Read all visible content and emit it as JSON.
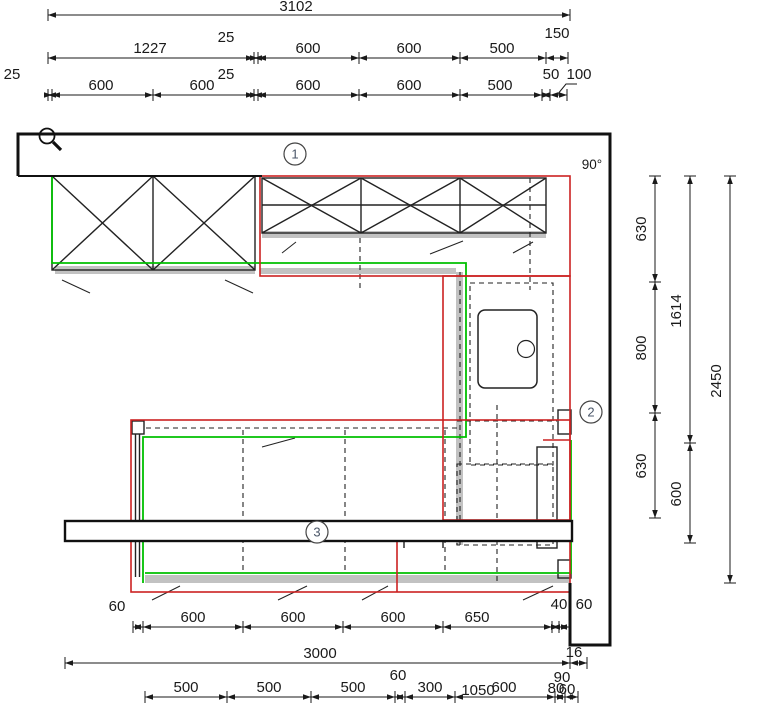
{
  "drawing": {
    "title": "kitchen-floor-plan",
    "angle_annotation": {
      "text": "90°",
      "x": 592,
      "y": 169
    },
    "callouts": [
      {
        "label": "1",
        "x": 295,
        "y": 154
      },
      {
        "label": "2",
        "x": 591,
        "y": 412
      },
      {
        "label": "3",
        "x": 317,
        "y": 532
      }
    ],
    "colors": {
      "dimension": "#1a1a1a",
      "wall": "#111111",
      "cabinet_outline_red": "#cc2222",
      "counter_outline_green": "#00c000",
      "shadow_gray": "#c2c2c2"
    },
    "dimension_chains": [
      {
        "id": "top-overall",
        "orientation": "h",
        "line": 15,
        "ticks": [
          48,
          570
        ],
        "labels": [
          {
            "text": "3102",
            "x": 296,
            "y": 11
          }
        ]
      },
      {
        "id": "top-row2",
        "orientation": "h",
        "line": 58,
        "ticks": [
          48,
          254,
          258,
          359,
          460,
          546,
          568
        ],
        "labels": [
          {
            "text": "1227",
            "x": 150,
            "y": 53
          },
          {
            "text": "25",
            "x": 226,
            "y": 42
          },
          {
            "text": "600",
            "x": 308,
            "y": 53
          },
          {
            "text": "600",
            "x": 409,
            "y": 53
          },
          {
            "text": "500",
            "x": 502,
            "y": 53
          },
          {
            "text": "150",
            "x": 557,
            "y": 38
          }
        ]
      },
      {
        "id": "top-row3",
        "orientation": "h",
        "line": 95,
        "ticks": [
          48,
          52,
          153,
          254,
          258,
          359,
          460,
          542,
          550,
          567
        ],
        "labels": [
          {
            "text": "25",
            "x": 12,
            "y": 79
          },
          {
            "text": "600",
            "x": 101,
            "y": 90
          },
          {
            "text": "600",
            "x": 202,
            "y": 90
          },
          {
            "text": "25",
            "x": 226,
            "y": 79
          },
          {
            "text": "600",
            "x": 308,
            "y": 90
          },
          {
            "text": "600",
            "x": 409,
            "y": 90
          },
          {
            "text": "500",
            "x": 500,
            "y": 90
          },
          {
            "text": "50",
            "x": 551,
            "y": 79
          },
          {
            "text": "100",
            "x": 579,
            "y": 79
          }
        ]
      },
      {
        "id": "bottom-row1",
        "orientation": "h",
        "line": 627,
        "ticks": [
          133,
          143,
          243,
          343,
          443,
          552,
          559,
          569
        ],
        "labels": [
          {
            "text": "60",
            "x": 117,
            "y": 611
          },
          {
            "text": "600",
            "x": 193,
            "y": 622
          },
          {
            "text": "600",
            "x": 293,
            "y": 622
          },
          {
            "text": "600",
            "x": 393,
            "y": 622
          },
          {
            "text": "650",
            "x": 477,
            "y": 622
          },
          {
            "text": "40",
            "x": 559,
            "y": 609
          },
          {
            "text": "60",
            "x": 584,
            "y": 609
          }
        ]
      },
      {
        "id": "bottom-row2",
        "orientation": "h",
        "line": 663,
        "ticks": [
          65,
          570,
          587
        ],
        "labels": [
          {
            "text": "3000",
            "x": 320,
            "y": 658
          },
          {
            "text": "16",
            "x": 574,
            "y": 657
          }
        ]
      },
      {
        "id": "bottom-row3",
        "orientation": "h",
        "line": 697,
        "ticks": [
          145,
          227,
          311,
          395,
          405,
          455,
          555,
          565,
          578
        ],
        "labels": [
          {
            "text": "500",
            "x": 186,
            "y": 692
          },
          {
            "text": "500",
            "x": 269,
            "y": 692
          },
          {
            "text": "500",
            "x": 353,
            "y": 692
          },
          {
            "text": "60",
            "x": 398,
            "y": 680
          },
          {
            "text": "300",
            "x": 430,
            "y": 692
          },
          {
            "text": "1050",
            "x": 478,
            "y": 695
          },
          {
            "text": "600",
            "x": 504,
            "y": 692
          },
          {
            "text": "90",
            "x": 562,
            "y": 682
          },
          {
            "text": "80",
            "x": 556,
            "y": 693
          },
          {
            "text": "60",
            "x": 567,
            "y": 694
          }
        ]
      },
      {
        "id": "right-col1",
        "orientation": "v",
        "line": 655,
        "ticks": [
          176,
          282,
          413,
          518
        ],
        "labels": [
          {
            "text": "630",
            "x": 646,
            "y": 229,
            "rotated": true
          },
          {
            "text": "800",
            "x": 646,
            "y": 348,
            "rotated": true
          },
          {
            "text": "630",
            "x": 646,
            "y": 466,
            "rotated": true
          }
        ]
      },
      {
        "id": "right-col2",
        "orientation": "v",
        "line": 690,
        "ticks": [
          176,
          443,
          543
        ],
        "labels": [
          {
            "text": "1614",
            "x": 681,
            "y": 311,
            "rotated": true
          },
          {
            "text": "600",
            "x": 681,
            "y": 494,
            "rotated": true
          }
        ]
      },
      {
        "id": "right-col3",
        "orientation": "v",
        "line": 730,
        "ticks": [
          176,
          583
        ],
        "labels": [
          {
            "text": "2450",
            "x": 721,
            "y": 381,
            "rotated": true
          }
        ]
      }
    ]
  }
}
